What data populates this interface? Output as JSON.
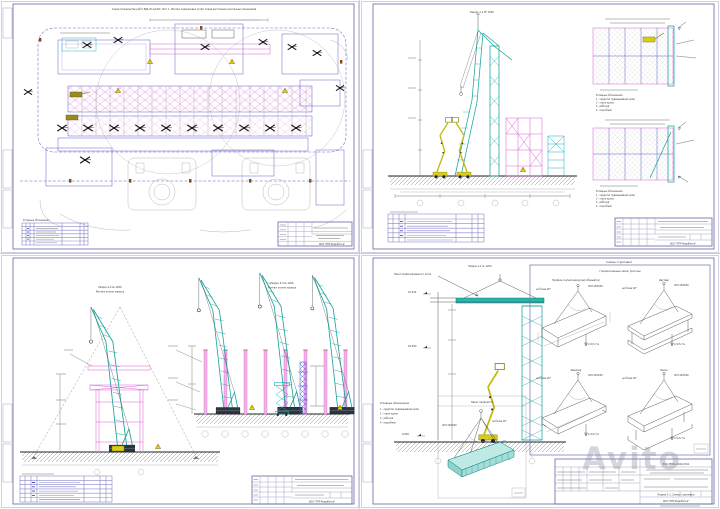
{
  "watermark": "Avito",
  "org": "ООО \"ППР Разработка\"",
  "legend": {
    "title": "Условные обозначения",
    "items": [
      "1 - средство подмащивания (млз)",
      "2 - строп крана",
      "3 - рабочий",
      "4 - подсобник"
    ]
  },
  "sheet1": {
    "top_title": "Схема производства работ РДК-25 №1200. Лист 1. Монтаж подкрановых путей. Схема расстановки монтажных механизмов",
    "legend_title": "Условные обозначения"
  },
  "sheet2": {
    "section_title": "Разрез 1-1 РГ-1200"
  },
  "sheet3": {
    "left_title": "Разрез 2-2 № 1200",
    "left_subtitle": "Монтаж колонн каркаса",
    "right_title": "Разрез 3-3 № 1200",
    "right_subtitle": "Монтаж колонн каркаса"
  },
  "sheet4": {
    "section_title": "Разрез 1-1 № 1200",
    "leader_label": "Пакет профилированного листа",
    "marks": {
      "top": "10.452",
      "mid": "10.000",
      "ground": "0.000"
    },
    "detail_title": "Пакет профлиста",
    "schemes_title": "Схемы строповки",
    "schemes_subtitle": "Горизонтальные связи, прогоны",
    "sling": "СКП-10/5000",
    "angle": "не более 90°",
    "length": "L=0,5-7 м",
    "beams": [
      "Профиль гнутый замкнутый (обрешётка)",
      "Двутавр",
      "Швеллер",
      "Балка"
    ],
    "title_block": {
      "code": "ЭКО-ППРм-2021/2011",
      "name": "Разрез 1-1. Схемы строповки"
    }
  }
}
